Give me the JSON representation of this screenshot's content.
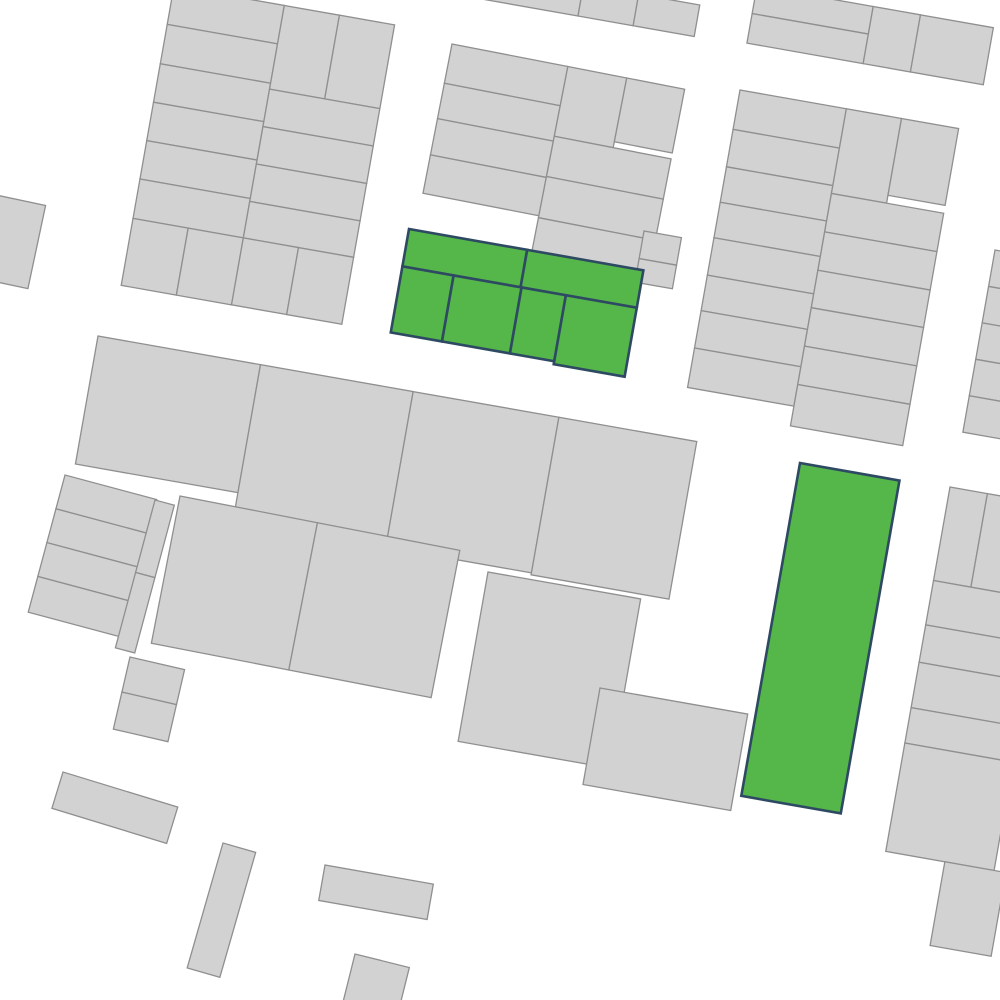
{
  "map": {
    "width": 1000,
    "height": 1000,
    "background": "#ffffff",
    "layers": {
      "parcels": {
        "fill": "#d2d2d2",
        "stroke": "#8f8f8f",
        "stroke_width": 1.3
      },
      "selected_parcels": {
        "fill": "#55b74a",
        "stroke": "#2e4a63",
        "stroke_width": 2.6
      }
    },
    "selected_count": 7,
    "blocks": [
      {
        "id": "block-top-left",
        "layer": "parcels",
        "origin": [
          174,
          -14
        ],
        "angle": 10,
        "rects": [
          [
            0,
            0,
            112,
            39
          ],
          [
            0,
            39,
            112,
            40
          ],
          [
            0,
            79,
            112,
            39
          ],
          [
            0,
            118,
            112,
            39
          ],
          [
            0,
            157,
            112,
            39
          ],
          [
            0,
            196,
            112,
            40
          ],
          [
            112,
            0,
            56,
            85
          ],
          [
            168,
            0,
            56,
            85
          ],
          [
            112,
            85,
            112,
            38
          ],
          [
            112,
            123,
            112,
            38
          ],
          [
            112,
            161,
            112,
            38
          ],
          [
            112,
            199,
            112,
            37
          ],
          [
            0,
            236,
            56,
            68
          ],
          [
            56,
            236,
            56,
            68
          ],
          [
            112,
            236,
            56,
            68
          ],
          [
            168,
            236,
            56,
            68
          ]
        ]
      },
      {
        "id": "block-top-edge",
        "layer": "parcels",
        "origin": [
          490,
          -32
        ],
        "angle": 10,
        "rects": [
          [
            0,
            0,
            95,
            32
          ],
          [
            95,
            0,
            56,
            32
          ],
          [
            151,
            0,
            62,
            32
          ]
        ]
      },
      {
        "id": "block-top-right-upper",
        "layer": "parcels",
        "origin": [
          757,
          -14
        ],
        "angle": 10,
        "rects": [
          [
            0,
            0,
            118,
            28
          ],
          [
            0,
            28,
            118,
            30
          ],
          [
            118,
            0,
            48,
            58
          ],
          [
            166,
            0,
            74,
            58
          ]
        ]
      },
      {
        "id": "block-top-middle",
        "layer": "parcels",
        "origin": [
          452,
          44
        ],
        "angle": 11,
        "rects": [
          [
            0,
            0,
            118,
            40
          ],
          [
            0,
            40,
            118,
            36
          ],
          [
            0,
            76,
            118,
            37
          ],
          [
            0,
            113,
            118,
            39
          ],
          [
            118,
            0,
            60,
            71
          ],
          [
            178,
            0,
            59,
            65
          ],
          [
            118,
            71,
            119,
            41
          ],
          [
            118,
            112,
            119,
            42
          ],
          [
            118,
            154,
            119,
            41
          ]
        ]
      },
      {
        "id": "block-top-middle-east",
        "layer": "parcels",
        "origin": [
          644,
          231
        ],
        "angle": 10,
        "rects": [
          [
            0,
            0,
            38,
            28
          ],
          [
            0,
            28,
            38,
            24
          ]
        ]
      },
      {
        "id": "block-top-right",
        "layer": "parcels",
        "origin": [
          740,
          90
        ],
        "angle": 10,
        "rects": [
          [
            0,
            0,
            108,
            40
          ],
          [
            0,
            40,
            108,
            38
          ],
          [
            0,
            78,
            108,
            36
          ],
          [
            0,
            114,
            108,
            36
          ],
          [
            0,
            150,
            108,
            38
          ],
          [
            0,
            188,
            108,
            36
          ],
          [
            0,
            224,
            108,
            38
          ],
          [
            0,
            262,
            108,
            40
          ],
          [
            108,
            0,
            56,
            86
          ],
          [
            164,
            0,
            58,
            78
          ],
          [
            108,
            86,
            114,
            39
          ],
          [
            108,
            125,
            114,
            39
          ],
          [
            108,
            164,
            114,
            38
          ],
          [
            108,
            202,
            114,
            39
          ],
          [
            108,
            241,
            114,
            39
          ],
          [
            108,
            280,
            114,
            42
          ]
        ]
      },
      {
        "id": "block-right-sliver",
        "layer": "parcels",
        "origin": [
          995,
          250
        ],
        "angle": 10,
        "rects": [
          [
            0,
            0,
            60,
            37
          ],
          [
            0,
            37,
            60,
            37
          ],
          [
            0,
            74,
            60,
            37
          ],
          [
            0,
            111,
            60,
            37
          ],
          [
            0,
            148,
            70,
            37
          ]
        ]
      },
      {
        "id": "block-middle-band",
        "layer": "parcels",
        "origin": [
          98,
          336
        ],
        "angle": 10,
        "rects": [
          [
            0,
            0,
            165,
            130
          ],
          [
            165,
            0,
            155,
            150
          ],
          [
            320,
            0,
            148,
            158
          ],
          [
            468,
            0,
            140,
            160
          ]
        ]
      },
      {
        "id": "block-left-strips",
        "layer": "parcels",
        "origin": [
          65,
          475
        ],
        "angle": 15,
        "rects": [
          [
            0,
            0,
            95,
            35
          ],
          [
            0,
            35,
            95,
            35
          ],
          [
            0,
            70,
            95,
            35
          ],
          [
            0,
            105,
            95,
            37
          ]
        ]
      },
      {
        "id": "block-left-sliver",
        "layer": "parcels",
        "origin": [
          155,
          500
        ],
        "angle": 15,
        "rects": [
          [
            0,
            0,
            20,
            75
          ],
          [
            0,
            75,
            20,
            78
          ]
        ]
      },
      {
        "id": "block-left-small",
        "layer": "parcels",
        "origin": [
          130,
          657
        ],
        "angle": 13,
        "rects": [
          [
            0,
            0,
            56,
            36
          ],
          [
            0,
            36,
            56,
            38
          ]
        ]
      },
      {
        "id": "block-mid-left",
        "layer": "parcels",
        "origin": [
          180,
          496
        ],
        "angle": 11,
        "rects": [
          [
            0,
            0,
            140,
            150
          ],
          [
            140,
            0,
            145,
            150
          ]
        ]
      },
      {
        "id": "block-center-south",
        "layer": "parcels",
        "origin": [
          488,
          572
        ],
        "angle": 10,
        "rects": [
          [
            0,
            0,
            155,
            172
          ]
        ]
      },
      {
        "id": "block-center-south-east",
        "layer": "parcels",
        "origin": [
          600,
          688
        ],
        "angle": 10,
        "rects": [
          [
            0,
            0,
            150,
            98
          ]
        ]
      },
      {
        "id": "block-right-strips",
        "layer": "parcels",
        "origin": [
          950,
          487
        ],
        "angle": 10,
        "rects": [
          [
            0,
            0,
            38,
            95
          ],
          [
            38,
            0,
            72,
            95
          ],
          [
            0,
            95,
            110,
            45
          ],
          [
            0,
            140,
            110,
            38
          ],
          [
            0,
            178,
            110,
            46
          ],
          [
            0,
            224,
            110,
            36
          ],
          [
            0,
            260,
            110,
            110
          ],
          [
            60,
            370,
            62,
            85
          ]
        ]
      },
      {
        "id": "parcel-west-edge",
        "layer": "parcels",
        "origin": [
          -18,
          192
        ],
        "angle": 12,
        "rects": [
          [
            0,
            0,
            65,
            85
          ]
        ]
      },
      {
        "id": "parcel-south-1",
        "layer": "parcels",
        "origin": [
          63,
          772
        ],
        "angle": 17,
        "rects": [
          [
            0,
            0,
            120,
            38
          ]
        ]
      },
      {
        "id": "parcel-south-2",
        "layer": "parcels",
        "origin": [
          223,
          843
        ],
        "angle": 16,
        "rects": [
          [
            0,
            0,
            34,
            130
          ]
        ]
      },
      {
        "id": "parcel-south-3",
        "layer": "parcels",
        "origin": [
          325,
          865
        ],
        "angle": 10,
        "rects": [
          [
            0,
            0,
            110,
            36
          ]
        ]
      },
      {
        "id": "parcel-south-4",
        "layer": "parcels",
        "origin": [
          355,
          954
        ],
        "angle": 14,
        "rects": [
          [
            0,
            0,
            56,
            60
          ]
        ]
      },
      {
        "id": "selected-cluster",
        "layer": "selected_parcels",
        "origin": [
          409,
          229
        ],
        "angle": 10,
        "rects": [
          [
            0,
            0,
            120,
            38
          ],
          [
            120,
            0,
            118,
            38
          ],
          [
            0,
            38,
            52,
            67
          ],
          [
            52,
            38,
            69,
            67
          ],
          [
            121,
            38,
            45,
            67
          ],
          [
            166,
            38,
            72,
            70
          ]
        ]
      },
      {
        "id": "selected-tall",
        "layer": "selected_parcels",
        "origin": [
          800,
          463
        ],
        "angle": 10,
        "rects": [
          [
            0,
            0,
            101,
            338
          ]
        ]
      }
    ]
  }
}
